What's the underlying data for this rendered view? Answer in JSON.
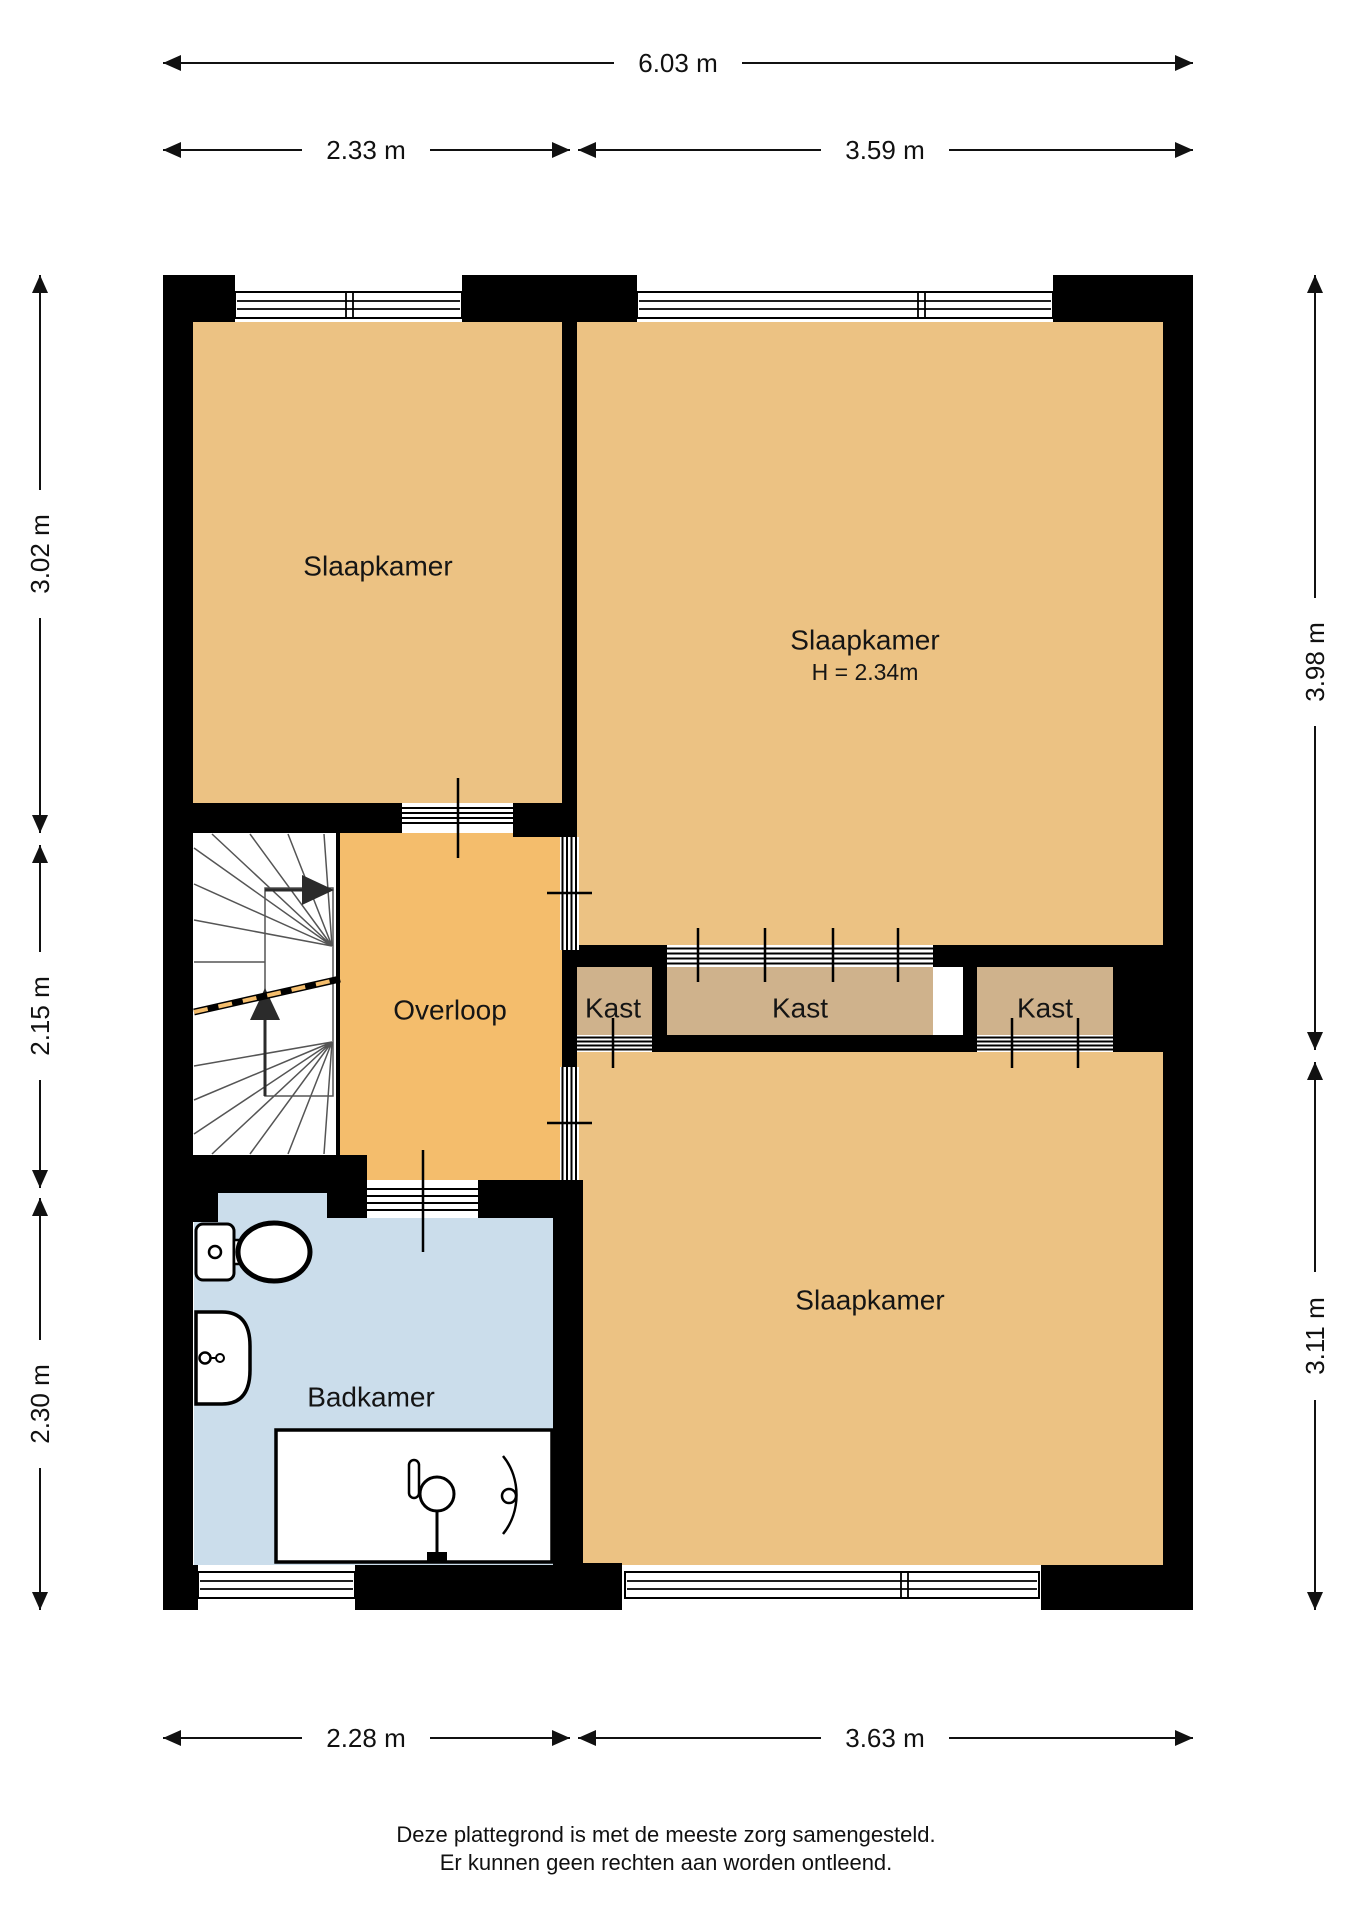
{
  "rooms": {
    "bedroom_top_left": {
      "label": "Slaapkamer"
    },
    "bedroom_top_right": {
      "label": "Slaapkamer",
      "ceiling_height": "H = 2.34m"
    },
    "landing": {
      "label": "Overloop"
    },
    "closet_left": {
      "label": "Kast"
    },
    "closet_middle": {
      "label": "Kast"
    },
    "closet_right": {
      "label": "Kast"
    },
    "bedroom_bottom": {
      "label": "Slaapkamer"
    },
    "bathroom": {
      "label": "Badkamer"
    }
  },
  "dimensions": {
    "top_total": "6.03 m",
    "top_left": "2.33 m",
    "top_right": "3.59 m",
    "left_top": "3.02 m",
    "left_middle": "2.15 m",
    "left_bottom": "2.30 m",
    "right_top": "3.98 m",
    "right_bottom": "3.11 m",
    "bottom_left": "2.28 m",
    "bottom_right": "3.63 m"
  },
  "footer": {
    "line1": "Deze plattegrond is met de meeste zorg samengesteld.",
    "line2": "Er kunnen geen rechten aan worden ontleend."
  },
  "colors": {
    "room_fill": "#ecc283",
    "landing_fill": "#f4bd6c",
    "closet_fill": "#cfb28c",
    "bathroom_fill": "#cbddeb",
    "wall": "#000000",
    "cutline_accent": "#f4bd6c"
  }
}
